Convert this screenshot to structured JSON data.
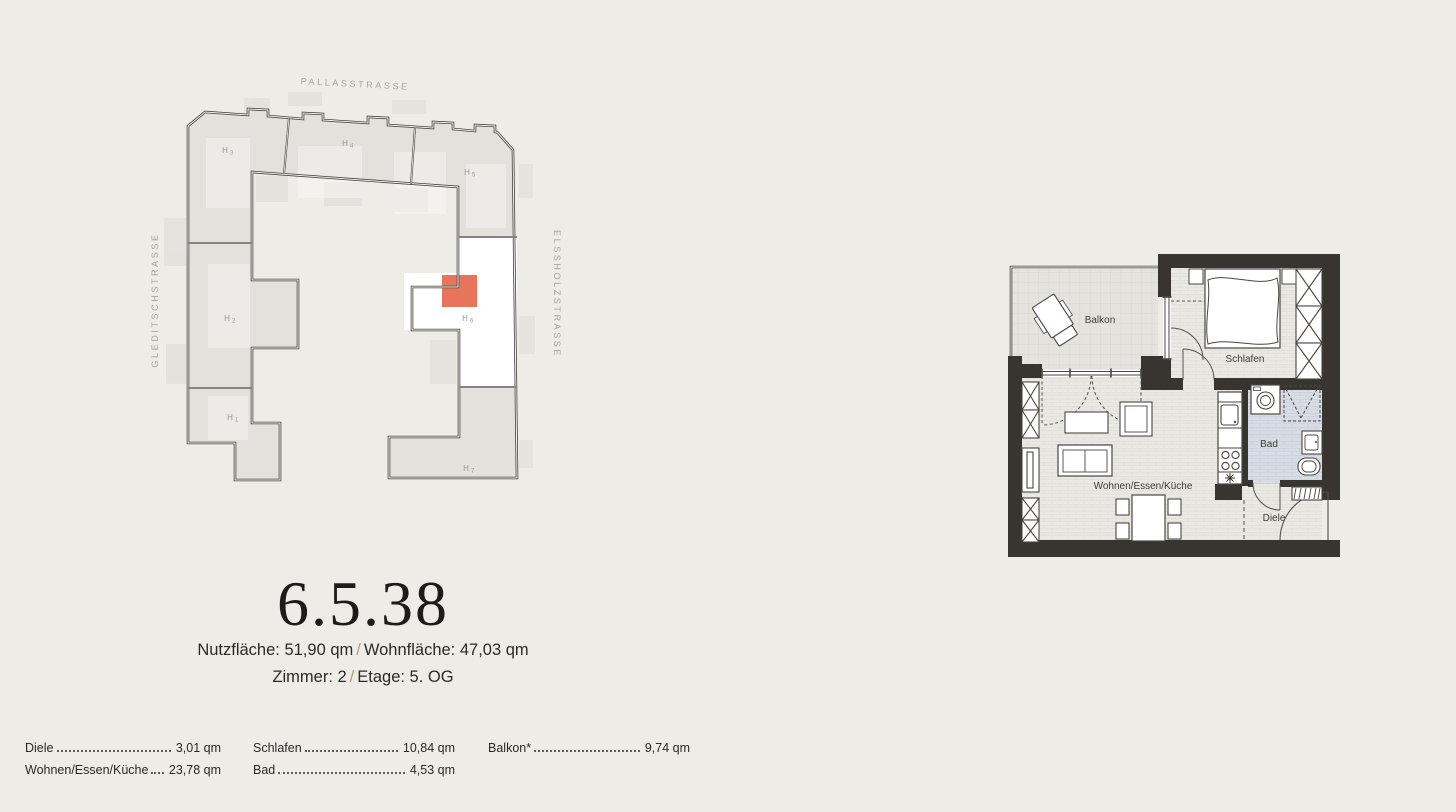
{
  "site_plan": {
    "street_top": "PALLASSTRASSE",
    "street_left": "GLEDITSCHSTRASSE",
    "street_right": "ELSSHOLZSTRASSE",
    "highlight_color": "#e8745c",
    "sections": [
      {
        "h": "H",
        "n": "1"
      },
      {
        "h": "H",
        "n": "2"
      },
      {
        "h": "H",
        "n": "3"
      },
      {
        "h": "H",
        "n": "4"
      },
      {
        "h": "H",
        "n": "5"
      },
      {
        "h": "H",
        "n": "6"
      },
      {
        "h": "H",
        "n": "7"
      }
    ]
  },
  "floor_plan": {
    "labels": {
      "balkon": "Balkon",
      "schlafen": "Schlafen",
      "wohnen": "Wohnen/Essen/Küche",
      "bad": "Bad",
      "diele": "Diele"
    }
  },
  "unit": {
    "number": "6.5.38",
    "area_line": {
      "left": "Nutzfläche: 51,90 qm",
      "separator": "/",
      "right": "Wohnfläche: 47,03 qm"
    },
    "detail_line": {
      "left": "Zimmer: 2",
      "separator": "/",
      "right": "Etage: 5. OG"
    }
  },
  "room_table": {
    "col1": [
      {
        "label": "Diele",
        "value": "3,01 qm"
      },
      {
        "label": "Wohnen/Essen/Küche",
        "value": "23,78 qm"
      }
    ],
    "col2": [
      {
        "label": "Schlafen",
        "value": "10,84 qm"
      },
      {
        "label": "Bad",
        "value": "4,53 qm"
      }
    ],
    "col3": [
      {
        "label": "Balkon*",
        "value": "9,74 qm"
      }
    ]
  }
}
